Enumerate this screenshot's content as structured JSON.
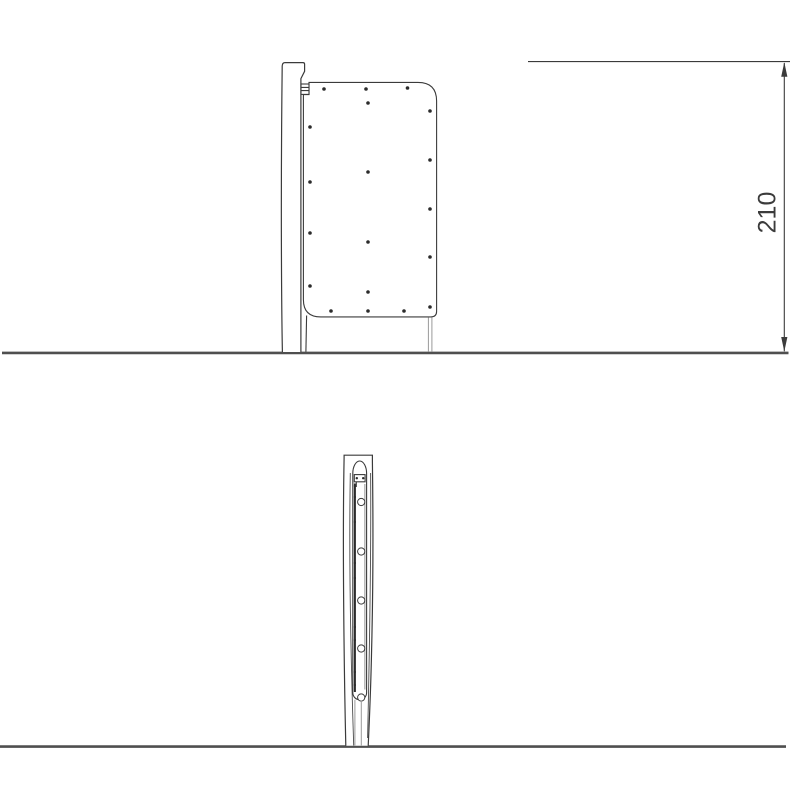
{
  "drawing": {
    "dimension_label": "210",
    "colors": {
      "background": "#ffffff",
      "line": "#3b3b3b",
      "ground": "#4f4f4f",
      "dark": "#2b2b2b",
      "light": "#9a9a9a"
    }
  },
  "side_view": {
    "description": "side elevation of post with panel",
    "screw_radius": 1.8,
    "screws": [
      [
        324,
        89
      ],
      [
        366,
        89
      ],
      [
        407.5,
        88
      ],
      [
        368,
        103
      ],
      [
        430,
        111
      ],
      [
        310,
        127
      ],
      [
        430,
        160
      ],
      [
        368,
        172
      ],
      [
        310,
        182
      ],
      [
        430,
        209
      ],
      [
        310,
        233
      ],
      [
        368,
        242
      ],
      [
        430,
        257
      ],
      [
        310,
        286
      ],
      [
        368,
        292
      ],
      [
        331,
        311
      ],
      [
        368,
        311
      ],
      [
        404,
        311
      ],
      [
        430,
        307
      ]
    ]
  },
  "front_view": {
    "description": "front elevation of post with panel edge",
    "bolts": {
      "cx": 361.2,
      "r": 3.6,
      "cy": [
        502,
        551.5,
        600.5,
        648.5,
        697.5
      ]
    },
    "screw_dots": {
      "cx": 354.9,
      "r": 1.1,
      "cy": [
        486,
        497,
        522,
        563,
        578,
        627,
        640,
        672,
        685
      ]
    },
    "bracket_dots": {
      "cy": 478.2,
      "r": 1.2,
      "cx": [
        356.8,
        363.2
      ]
    }
  }
}
